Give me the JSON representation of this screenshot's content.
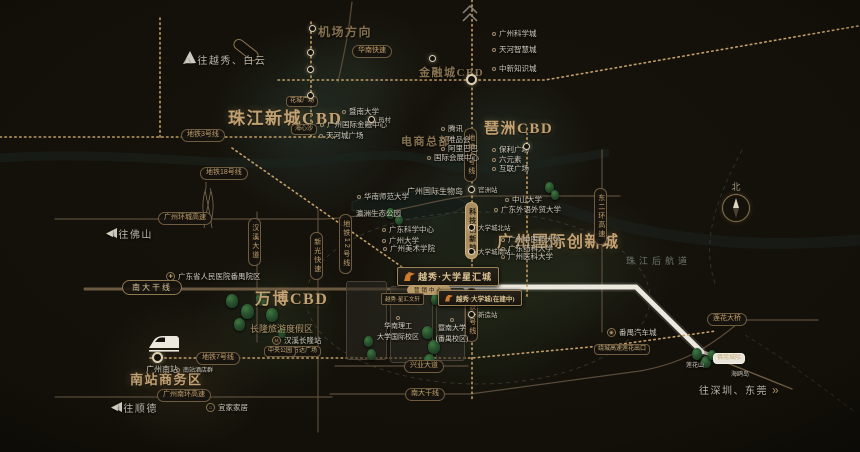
{
  "project": {
    "name": "越秀·大学星汇城",
    "marketing_center": "营销中心",
    "phase2": "越秀·大学城(在建中)",
    "side_tag": "越秀·星汇文轩",
    "logo_color": "#cf7a2c"
  },
  "map": {
    "accent_gold": "#c2a172",
    "metro_dot_color": "#c39e66",
    "highway_white": "#ece8dd",
    "compass": {
      "north": "北"
    },
    "zones": [
      {
        "id": "zhujiang-new-town-cbd",
        "label": "珠江新城CBD",
        "x": 228,
        "y": 104,
        "fs": 17
      },
      {
        "id": "pazhou-cbd",
        "label": "琶洲CBD",
        "x": 484,
        "y": 117,
        "fs": 15
      },
      {
        "id": "financial-city-cbd",
        "label": "金融城CBD",
        "x": 419,
        "y": 64,
        "fs": 11,
        "dim": true
      },
      {
        "id": "wanbo-cbd",
        "label": "万博CBD",
        "x": 255,
        "y": 285,
        "fs": 16
      },
      {
        "id": "innovation-city",
        "label": "广州国际创新城",
        "x": 497,
        "y": 228,
        "fs": 16
      },
      {
        "id": "south-station-biz",
        "label": "南站商务区",
        "x": 130,
        "y": 369,
        "fs": 13
      },
      {
        "id": "ecommerce-hq",
        "label": "电商总部",
        "x": 401,
        "y": 133,
        "fs": 11,
        "dim": true
      },
      {
        "id": "airport-direction",
        "label": "机场方向",
        "x": 318,
        "y": 23,
        "fs": 12,
        "dim": true
      },
      {
        "id": "pearl-river-back-channel",
        "label": "珠江后航道",
        "x": 626,
        "y": 254,
        "fs": 9,
        "water": true
      }
    ],
    "directions": [
      {
        "id": "to-yuexiu-baiyun",
        "label": "往越秀、白云",
        "x": 183,
        "y": 52,
        "arrow": "up"
      },
      {
        "id": "to-foshan",
        "label": "往佛山",
        "x": 106,
        "y": 226,
        "arrow": "left"
      },
      {
        "id": "to-shunde",
        "label": "往顺德",
        "x": 111,
        "y": 400,
        "arrow": "left"
      },
      {
        "id": "to-shenzhen-dongguan",
        "label": "往深圳、东莞",
        "x": 699,
        "y": 382,
        "arrow": "right",
        "trail": true
      }
    ],
    "pills": [
      {
        "id": "metro-line3",
        "label": "地铁3号线",
        "x": 181,
        "y": 129
      },
      {
        "id": "metro-line18",
        "label": "地铁18号线",
        "x": 200,
        "y": 167
      },
      {
        "id": "huanan-expressway",
        "label": "华南快速",
        "x": 352,
        "y": 45
      },
      {
        "id": "ring-expressway",
        "label": "广州环城高速",
        "x": 158,
        "y": 212
      },
      {
        "id": "nanda-trunk-west",
        "label": "南大干线",
        "x": 122,
        "y": 280,
        "style": "big"
      },
      {
        "id": "metro-line7",
        "label": "地铁7号线",
        "x": 196,
        "y": 352
      },
      {
        "id": "south-ring-expressway",
        "label": "广州南环高速",
        "x": 157,
        "y": 389
      },
      {
        "id": "xingye-avenue",
        "label": "兴业大道",
        "x": 404,
        "y": 360
      },
      {
        "id": "nanda-trunk-east",
        "label": "南大干线",
        "x": 405,
        "y": 388
      },
      {
        "id": "lianhua-bridge",
        "label": "莲花大桥",
        "x": 707,
        "y": 313
      },
      {
        "id": "raocheng-lianhua-exit",
        "label": "绕城高速莲花出口",
        "x": 594,
        "y": 344,
        "style": "tag"
      },
      {
        "id": "wanda-plaza-tag",
        "label": "万达广场",
        "x": 289,
        "y": 346,
        "style": "tag"
      },
      {
        "id": "central-park-tag",
        "label": "中央公园",
        "x": 264,
        "y": 346,
        "style": "tag"
      },
      {
        "id": "huacheng-square-tag",
        "label": "花城广场",
        "x": 286,
        "y": 96,
        "style": "tag"
      },
      {
        "id": "haixinsha-tag",
        "label": "海心沙",
        "x": 291,
        "y": 124,
        "style": "tag"
      },
      {
        "id": "metro-line4-north",
        "label": "地铁4号线",
        "x": 464,
        "y": 128,
        "v": true
      },
      {
        "id": "metro-line4-south",
        "label": "地铁4号线",
        "x": 465,
        "y": 288,
        "v": true
      },
      {
        "id": "tech-innovation-axis",
        "label": "科技创新轴",
        "x": 465,
        "y": 202,
        "v": true,
        "fill": true
      },
      {
        "id": "metro-line12",
        "label": "地铁12号线",
        "x": 339,
        "y": 214,
        "v": true
      },
      {
        "id": "hanxi-avenue",
        "label": "汉溪大道",
        "x": 248,
        "y": 218,
        "v": true
      },
      {
        "id": "xinguang-expressway",
        "label": "新光快速",
        "x": 310,
        "y": 232,
        "v": true
      },
      {
        "id": "east-2nd-ring-expressway",
        "label": "东二环高速",
        "x": 594,
        "y": 188,
        "v": true
      },
      {
        "id": "foguan-intercity",
        "label": "佛莞城际",
        "x": 713,
        "y": 353,
        "white": true,
        "style": "tag"
      }
    ],
    "pois": [
      {
        "id": "jinan-university",
        "label": "暨南大学",
        "x": 342,
        "y": 106
      },
      {
        "id": "guangzhou-ifc",
        "label": "广州国际金融中心",
        "x": 320,
        "y": 119
      },
      {
        "id": "teemall-plaza",
        "label": "天河城广场",
        "x": 319,
        "y": 130
      },
      {
        "id": "gz-science-city",
        "label": "广州科学城",
        "x": 492,
        "y": 28
      },
      {
        "id": "tianhe-smart-city",
        "label": "天河智慧城",
        "x": 492,
        "y": 44
      },
      {
        "id": "sino-sg-knowledge-city",
        "label": "中新知识城",
        "x": 492,
        "y": 63
      },
      {
        "id": "tencent",
        "label": "腾讯",
        "x": 441,
        "y": 123
      },
      {
        "id": "vipshop",
        "label": "唯品会",
        "x": 441,
        "y": 134
      },
      {
        "id": "alibaba",
        "label": "阿里巴巴",
        "x": 441,
        "y": 143
      },
      {
        "id": "intl-convention-center",
        "label": "国际会展中心",
        "x": 427,
        "y": 152
      },
      {
        "id": "poly-plaza",
        "label": "保利广场",
        "x": 492,
        "y": 144
      },
      {
        "id": "six-elements",
        "label": "六元素",
        "x": 492,
        "y": 154
      },
      {
        "id": "internet-plaza",
        "label": "互联广场",
        "x": 492,
        "y": 163
      },
      {
        "id": "gz-intl-bio-island",
        "label": "广州国际生物岛",
        "x": 407,
        "y": 186,
        "fs": 8,
        "plain": true
      },
      {
        "id": "yingzhou-eco-park",
        "label": "瀛洲生态公园",
        "x": 356,
        "y": 208,
        "plain": true
      },
      {
        "id": "south-china-normal-univ",
        "label": "华南师范大学",
        "x": 357,
        "y": 191
      },
      {
        "id": "gd-science-center",
        "label": "广东科学中心",
        "x": 382,
        "y": 224
      },
      {
        "id": "guangzhou-university",
        "label": "广州大学",
        "x": 382,
        "y": 235
      },
      {
        "id": "gz-academy-fine-arts",
        "label": "广州美术学院",
        "x": 383,
        "y": 243
      },
      {
        "id": "sun-yat-sen-university",
        "label": "中山大学",
        "x": 505,
        "y": 194
      },
      {
        "id": "gdufs",
        "label": "广东外语外贸大学",
        "x": 494,
        "y": 204
      },
      {
        "id": "gz-univ-chinese-medicine",
        "label": "广州中医药大学",
        "x": 501,
        "y": 234
      },
      {
        "id": "gd-pharmaceutical-univ",
        "label": "广东药科大学",
        "x": 501,
        "y": 243
      },
      {
        "id": "gz-medical-university",
        "label": "广州医科大学",
        "x": 501,
        "y": 251
      },
      {
        "id": "changlong-resort",
        "label": "长隆旅游度假区",
        "x": 250,
        "y": 322,
        "gold": true,
        "fs": 9,
        "plain": true
      },
      {
        "id": "hanxi-changlong-station",
        "label": "汉溪长隆站",
        "x": 272,
        "y": 335,
        "icon": "metro"
      },
      {
        "id": "gd-people-hospital-panyu",
        "label": "广东省人民医院番禺院区",
        "x": 166,
        "y": 271,
        "icon": "cross"
      },
      {
        "id": "south-station-hotels",
        "label": "南站酒店群",
        "x": 176,
        "y": 365,
        "fs": 6
      },
      {
        "id": "ikea",
        "label": "宜家家居",
        "x": 206,
        "y": 402,
        "icon": "home"
      },
      {
        "id": "gz-south-railway-station",
        "label": "广州南站",
        "x": 146,
        "y": 364,
        "plain": true,
        "fs": 8
      },
      {
        "id": "panyu-auto-city",
        "label": "番禺汽车城",
        "x": 607,
        "y": 327,
        "icon": "car"
      },
      {
        "id": "lianhua-mountain",
        "label": "莲花山",
        "x": 686,
        "y": 360,
        "fs": 6,
        "plain": true
      },
      {
        "id": "haiou-island",
        "label": "海鸥岛",
        "x": 731,
        "y": 369,
        "fs": 6,
        "plain": true
      }
    ],
    "stations": [
      {
        "id": "station-financial-interchange",
        "x": 466,
        "y": 74,
        "big": true
      },
      {
        "id": "station-yuancun",
        "x": 368,
        "y": 116,
        "label": "员村",
        "lx": 378,
        "ly": 114
      },
      {
        "id": "station-airport-line",
        "x": 309,
        "y": 25
      },
      {
        "id": "station-financial-badge",
        "x": 429,
        "y": 55
      },
      {
        "id": "station-line3-a",
        "x": 307,
        "y": 49
      },
      {
        "id": "station-line3-b",
        "x": 307,
        "y": 66
      },
      {
        "id": "station-line3-c",
        "x": 307,
        "y": 92
      },
      {
        "id": "station-guanzhou",
        "x": 468,
        "y": 186,
        "label": "官洲站",
        "lx": 478,
        "ly": 184
      },
      {
        "id": "station-hedc-north",
        "x": 468,
        "y": 224,
        "label": "大学城北站",
        "lx": 478,
        "ly": 222
      },
      {
        "id": "station-hedc-south",
        "x": 468,
        "y": 248,
        "label": "大学城南站",
        "lx": 478,
        "ly": 246
      },
      {
        "id": "station-xinzao",
        "x": 468,
        "y": 311,
        "label": "新造站",
        "lx": 478,
        "ly": 309
      },
      {
        "id": "station-pazhou",
        "x": 523,
        "y": 143
      },
      {
        "id": "station-gz-south",
        "x": 152,
        "y": 352,
        "big": true
      }
    ],
    "campus_labels": [
      {
        "id": "scut-international-campus",
        "lines": [
          "华南理工",
          "大学国际校区"
        ],
        "x": 370,
        "y": 316
      },
      {
        "id": "jinan-univ-panyu-campus",
        "lines": [
          "暨南大学",
          "(番禺校区)"
        ],
        "x": 424,
        "y": 318
      }
    ]
  }
}
